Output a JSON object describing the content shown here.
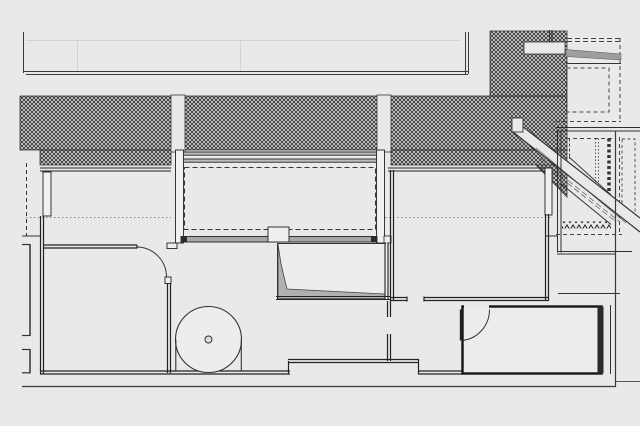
{
  "rooms": {
    "terrace": {
      "en": "TERRACE",
      "hu": "TERASZ",
      "area": "13,74 m²"
    },
    "airspace": {
      "en": "AIRSPACE",
      "hu": "LÉGTÉR"
    },
    "bedroom_left": {
      "en": "BEDROOM",
      "hu": "HÁLÓ",
      "area": "18,98 m²"
    },
    "loft": {
      "en": "LOFT",
      "hu": "GALÉRIA",
      "area": "12,80 m²"
    },
    "bedroom_right": {
      "en": "BEDROOM",
      "hu": "HÁLÓ",
      "area": "14,24 m²"
    },
    "passage": {
      "en": "PASSAGE",
      "hu": "KÖZLEKEDŐ",
      "area": "3,72 m²"
    },
    "bathroom": {
      "en": "BATHROOM",
      "hu": "FÜRDŐ",
      "area": "7,74 m²"
    }
  },
  "colors": {
    "background": "#e9e9e9",
    "line": "#1c1c1c",
    "glazing_gray": "#a8a8a8",
    "wedge_gray": "#b0b0b0",
    "hatch_base": "#d9d9d9"
  }
}
